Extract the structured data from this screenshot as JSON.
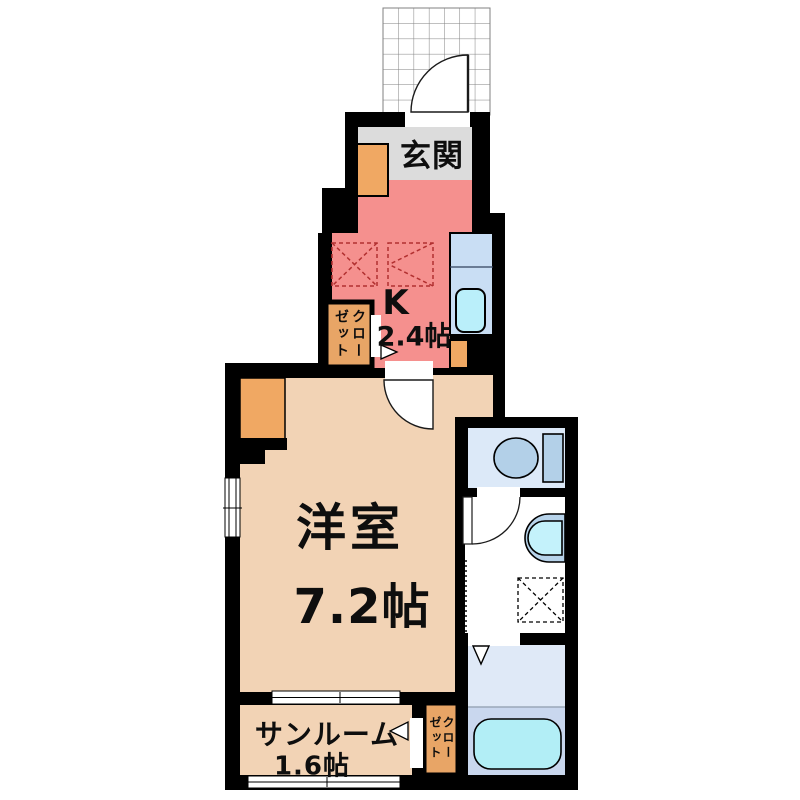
{
  "plan": {
    "title": "1K apartment floor plan",
    "rooms": {
      "genkan": {
        "label": "玄関"
      },
      "kitchen": {
        "label": "K",
        "size": "2.4帖"
      },
      "western_room": {
        "label": "洋室",
        "size": "7.2帖"
      },
      "sunroom": {
        "label": "サンルーム",
        "size": "1.6帖"
      },
      "kitchen_closet": {
        "label": "クローゼット"
      },
      "sunroom_closet": {
        "label": "クローゼット"
      }
    },
    "fixtures": {
      "porch": "entrance-porch-tiles",
      "shoe_cabinet": "shoe-cabinet",
      "counter": "kitchen-counter",
      "sink": "kitchen-sink",
      "appliance_spaces": "refrigerator-space",
      "toilet": "toilet",
      "washbasin": "washbasin",
      "washer_space": "washing-machine-space",
      "bathtub": "bathtub"
    },
    "colors": {
      "wall": "#000000",
      "genkan_floor": "#dcdcdc",
      "kitchen_floor": "#f5908e",
      "room_floor": "#f2d3b5",
      "closet_fill": "#e8a566",
      "cabinet_fill": "#f0a863",
      "counter_fill": "#c9def4",
      "sink_fill": "#baeffa",
      "toilet_fill": "#b3d0e8",
      "toilet_floor": "#dce9f8",
      "bath_floor": "#dfe9f7",
      "bath_floor_lower": "#c9d7ee",
      "bathtub_fill": "#b2eef6",
      "basin_outer": "#b7d3ea",
      "basin_inner": "#c4f2fb",
      "marker_red": "#b23030",
      "tile_line": "#808080"
    }
  }
}
